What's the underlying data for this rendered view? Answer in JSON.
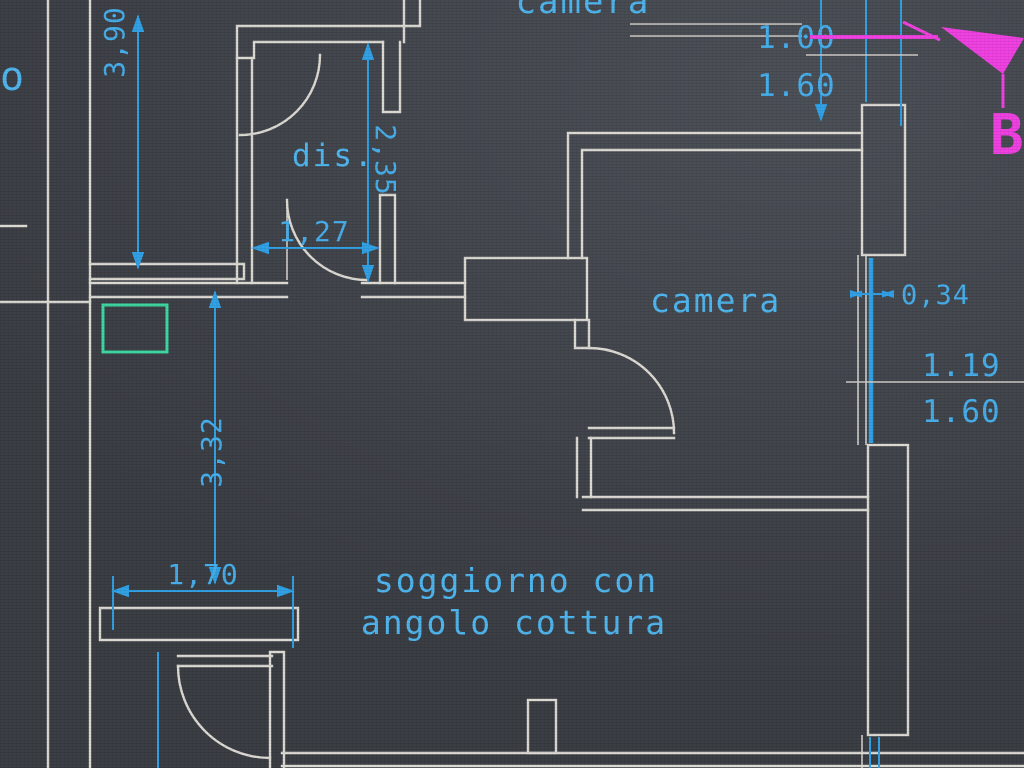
{
  "app": {
    "description": "CAD floor plan drawing (photo of screen)",
    "background_color": "#42464d",
    "wall_color": "#dcd9d3",
    "dimension_color": "#2fa0e4",
    "text_color": "#4db5ee",
    "section_marker_color": "#ee3fe0",
    "highlight_box_color": "#3bd6a0"
  },
  "labels": {
    "camera_top": "camera",
    "room_left_partial": "o",
    "dis": "dis.",
    "camera_right": "camera",
    "soggiorno_line1": "soggiorno con",
    "soggiorno_line2": "angolo cottura"
  },
  "dimensions": {
    "d390": "3,90",
    "d235": "2,35",
    "d127": "1,27",
    "d332": "3,32",
    "d170": "1,70",
    "d034": "0,34",
    "window_top_width": "1.00",
    "window_top_height": "1.60",
    "window_right_width": "1.19",
    "window_right_height": "1.60"
  },
  "section": {
    "label": "B"
  }
}
